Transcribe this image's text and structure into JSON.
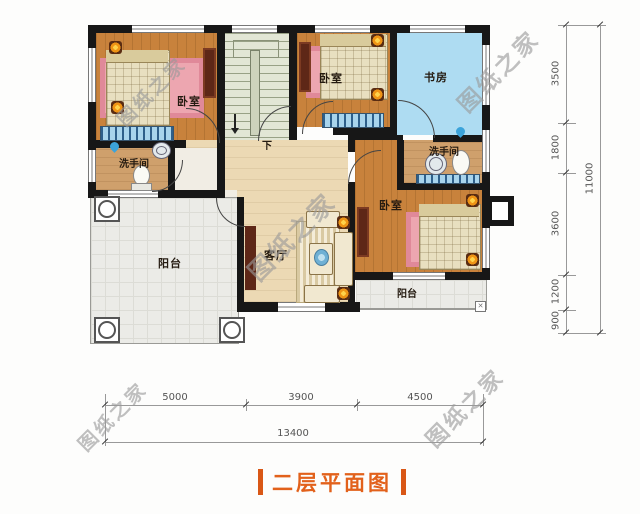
{
  "title": {
    "text": "二层平面图",
    "accent_color": "#e2611b"
  },
  "watermark": {
    "text": "图纸之家"
  },
  "labels": {
    "bedroom_top_left": "卧室",
    "bedroom_top_mid": "卧室",
    "bedroom_right": "卧室",
    "study": "书房",
    "bath_left": "洗手间",
    "bath_right": "洗手间",
    "living": "客厅",
    "balcony_left": "阳台",
    "balcony_bottom": "阳台",
    "stairs_down": "下"
  },
  "dimensions": {
    "right": {
      "segments": [
        "3500",
        "1800",
        "3600",
        "1200",
        "900"
      ],
      "total": "11000"
    },
    "bottom": {
      "segments": [
        "5000",
        "3900",
        "4500"
      ],
      "total": "13400"
    }
  },
  "misc": {
    "corner_mark": "✕"
  },
  "colors": {
    "wall": "#171717",
    "bedroom_floor": "#c8823c",
    "study_floor": "#aedcf2",
    "hall_floor": "#ecd9b4",
    "balcony_floor": "#ebebe7",
    "title_accent": "#e2611b",
    "watermark": "#9a9a9a"
  }
}
